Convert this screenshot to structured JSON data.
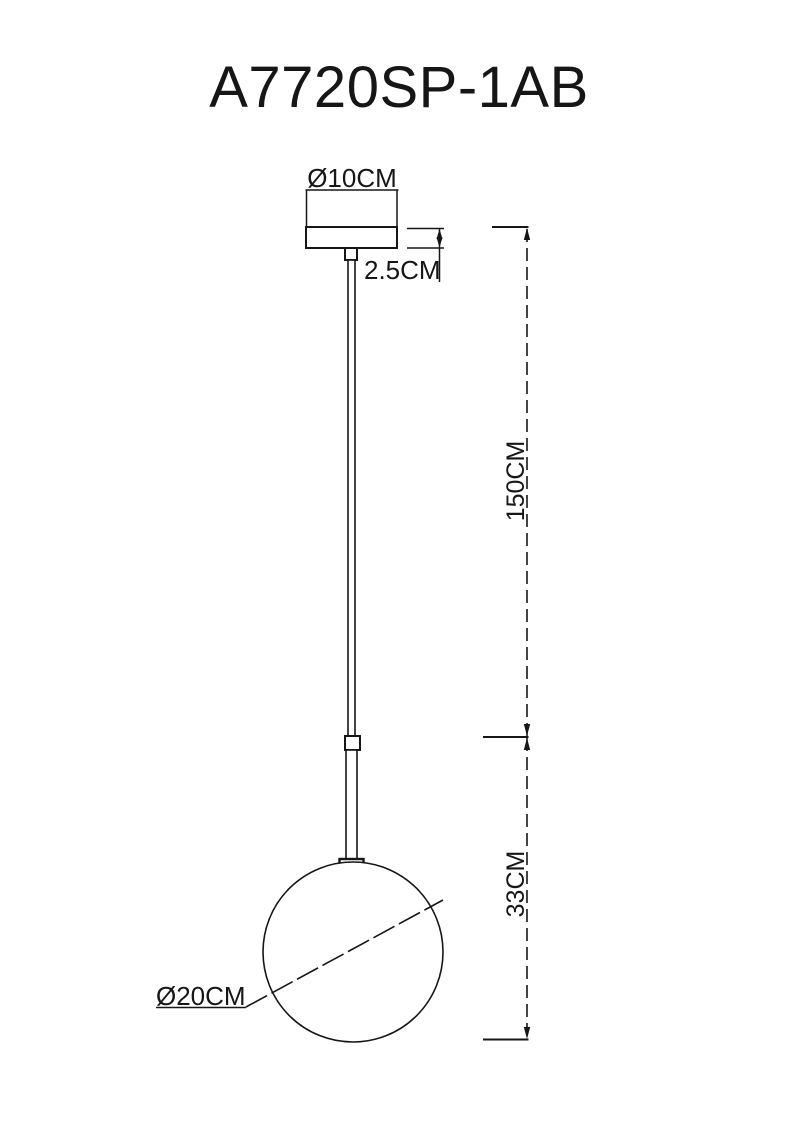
{
  "title": "A7720SP-1AB",
  "drawing": {
    "type": "pendant-lamp-dimension-diagram",
    "labels": {
      "canopy_diameter": "Ø10CM",
      "canopy_height": "2.5CM",
      "suspension_length": "150CM",
      "shade_section_height": "33CM",
      "globe_diameter": "Ø20CM"
    },
    "colors": {
      "line": "#161616",
      "background": "#ffffff"
    }
  }
}
